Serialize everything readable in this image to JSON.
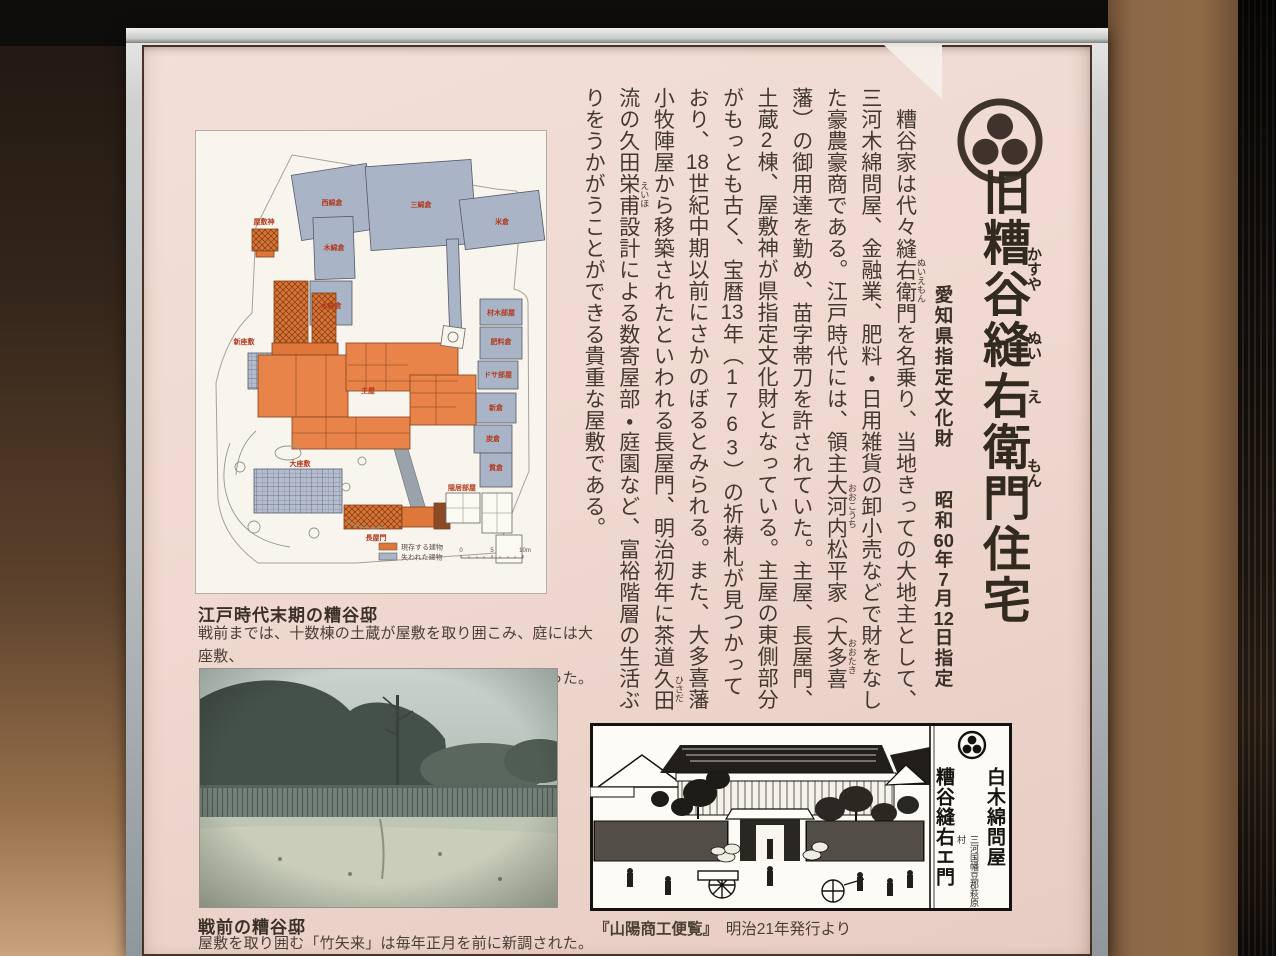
{
  "sign": {
    "crest_name": "maru-ni-mitsuboshi-crest",
    "crest_color": "#3f332b",
    "title": {
      "segments": [
        {
          "t": "旧"
        },
        {
          "t": "糟谷",
          "r": "かすや"
        },
        {
          "t": "縫",
          "r": "ぬい"
        },
        {
          "t": "右",
          "r": "え"
        },
        {
          "t": "衛門",
          "r": "もん"
        },
        {
          "t": "住宅"
        }
      ]
    },
    "designation": {
      "segments": [
        {
          "t": "愛知県指定文化財　　"
        },
        {
          "t": "昭和"
        },
        {
          "t": "60",
          "cls": "tcy"
        },
        {
          "t": "年"
        },
        {
          "t": "7",
          "cls": "tcy"
        },
        {
          "t": "月"
        },
        {
          "t": "12",
          "cls": "tcy"
        },
        {
          "t": "日指定"
        }
      ]
    },
    "main_text": {
      "segments": [
        {
          "t": "　糟谷家は代々"
        },
        {
          "t": "縫右衛門",
          "r": "ぬいえもん"
        },
        {
          "t": "を名乗り、当地きっての大地主として、三河木綿問屋、金融業、肥料・日用雑貨の卸小売などで財をなした豪農豪商である。江戸時代には、領主"
        },
        {
          "t": "大河内",
          "r": "おおこうち"
        },
        {
          "t": "松平家（"
        },
        {
          "t": "大多喜",
          "r": "おおたき"
        },
        {
          "t": "藩）の御用達を勤め、苗字帯刀を許されていた。主屋、長屋門、土蔵"
        },
        {
          "t": "2",
          "cls": "tcy"
        },
        {
          "t": "棟、屋敷神が県指定文化財となっている。主屋の東側部分がもっとも古く、宝暦"
        },
        {
          "t": "13",
          "cls": "tcy"
        },
        {
          "t": "年（"
        },
        {
          "t": "1763",
          "cls": "up"
        },
        {
          "t": "）の祈祷札が見つかっており、"
        },
        {
          "t": "18",
          "cls": "tcy"
        },
        {
          "t": "世紀中期以前にさかのぼるとみられる。また、大多喜藩小牧陣屋から移築されたといわれる長屋門、明治初年に茶道"
        },
        {
          "t": "久田",
          "r": "ひさだ"
        },
        {
          "t": "流の久田"
        },
        {
          "t": "栄甫",
          "r": "えいほ"
        },
        {
          "t": "設計による数寄屋部・庭園など、富裕階層の生活ぶりをうかがうことができる貴重な屋敷である。"
        }
      ]
    }
  },
  "floor_plan": {
    "heading": "江戸時代末期の糟谷邸",
    "caption_line1": "戦前までは、十数棟の土蔵が屋敷を取り囲こみ、庭には大座敷、",
    "caption_line2": "裏手には跡取り夫婦のための新座敷などの建物があった。",
    "legend": [
      {
        "label": "現存する建物",
        "color": "#dd7637"
      },
      {
        "label": "失われた建物",
        "color": "#aab4c7"
      }
    ],
    "scale": {
      "ticks": [
        "0",
        "5",
        "10m"
      ]
    },
    "labels": [
      {
        "text": "西綿倉",
        "x": 136,
        "y": 74
      },
      {
        "text": "三綿倉",
        "x": 225,
        "y": 76
      },
      {
        "text": "米倉",
        "x": 306,
        "y": 93
      },
      {
        "text": "木綿倉",
        "x": 138,
        "y": 119
      },
      {
        "text": "木綿倉",
        "x": 135,
        "y": 177
      },
      {
        "text": "屋敷神",
        "x": 68,
        "y": 93
      },
      {
        "text": "新座敷",
        "x": 48,
        "y": 213
      },
      {
        "text": "主屋",
        "x": 172,
        "y": 262
      },
      {
        "text": "大座敷",
        "x": 104,
        "y": 335
      },
      {
        "text": "長屋門",
        "x": 180,
        "y": 409
      },
      {
        "text": "隠居部屋",
        "x": 266,
        "y": 359
      },
      {
        "text": "材木部屋",
        "x": 305,
        "y": 184
      },
      {
        "text": "肥料倉",
        "x": 305,
        "y": 213
      },
      {
        "text": "ドサ部屋",
        "x": 302,
        "y": 246
      },
      {
        "text": "新倉",
        "x": 300,
        "y": 279
      },
      {
        "text": "炭倉",
        "x": 297,
        "y": 310
      },
      {
        "text": "質倉",
        "x": 300,
        "y": 339
      }
    ]
  },
  "photo": {
    "heading": "戦前の糟谷邸",
    "caption": "屋敷を取り囲む「竹矢来」は毎年正月を前に新調された。"
  },
  "print": {
    "caption_title": "『山陽商工便覧』",
    "caption_rest": "　明治21年発行より",
    "panel": {
      "shop": "白木綿問屋",
      "address": "三河国幡豆郡萩原村",
      "owner": "糟谷縫右エ門"
    }
  }
}
